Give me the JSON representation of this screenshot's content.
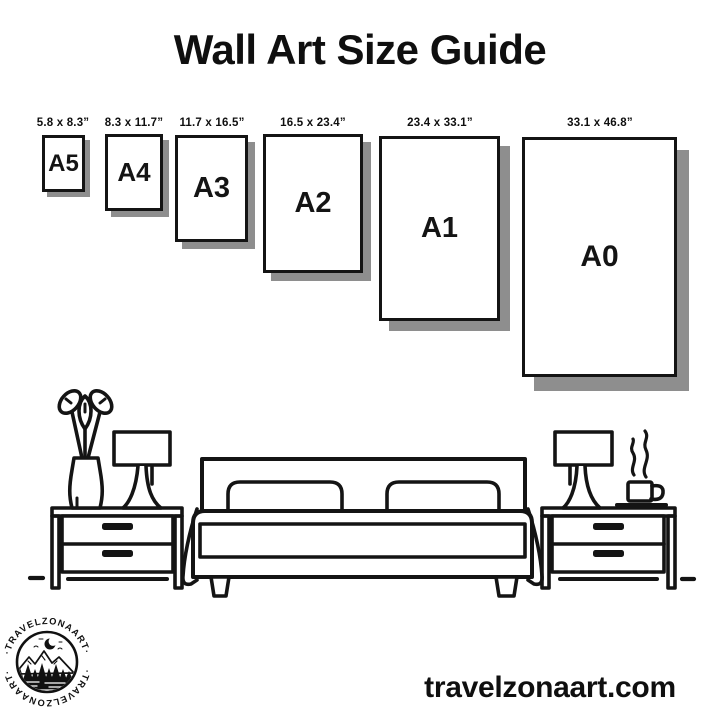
{
  "title": "Wall Art Size Guide",
  "sizes": [
    {
      "code": "A5",
      "dims": "5.8 x 8.3”"
    },
    {
      "code": "A4",
      "dims": "8.3 x 11.7”"
    },
    {
      "code": "A3",
      "dims": "11.7 x 16.5”"
    },
    {
      "code": "A2",
      "dims": "16.5 x 23.4”"
    },
    {
      "code": "A1",
      "dims": "23.4 x 33.1”"
    },
    {
      "code": "A0",
      "dims": "33.1 x 46.8”"
    }
  ],
  "footer": {
    "website": "travelzonaart.com"
  },
  "logo": {
    "text_top": "·TRAVELZONAART·",
    "text_bottom": "·TRAVELZONAART·"
  },
  "colors": {
    "ink": "#141414",
    "paper_shadow": "#8e8e8e",
    "background": "#ffffff"
  }
}
